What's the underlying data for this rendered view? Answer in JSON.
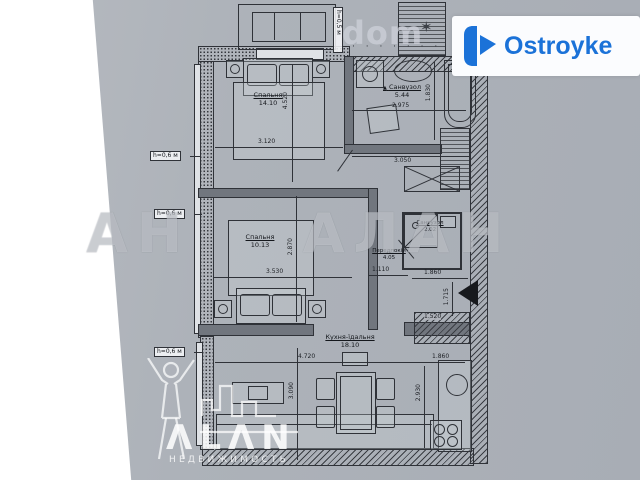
{
  "branding": {
    "ostroyke_label": "Ostroyke",
    "dom_label": "dom",
    "dom_dots": "· · · · · · ·",
    "star_icon": "✶",
    "watermark_big": "АН АЛАН",
    "alan_name": "ΛLΛN",
    "alan_subtitle": "НЕДВИЖИМОСТЬ"
  },
  "plan": {
    "drain_icon": "▲",
    "rooms": [
      {
        "name": "Спальня",
        "area": "14.10"
      },
      {
        "name": "Санвузол",
        "area": "5.44"
      },
      {
        "name": "Спальня",
        "area": "10.13"
      },
      {
        "name": "Санвузол",
        "area": "2.02"
      },
      {
        "name": "Передпокій",
        "area": "4.05"
      },
      {
        "name": "Кухня-їдальня",
        "area": "18.10"
      }
    ],
    "height_labels": [
      "h=0,6 м",
      "h=0,6 м",
      "h=0,6 м",
      "h=0,5 м"
    ],
    "dimensions": {
      "room1_w": "3.120",
      "room1_h": "4.520",
      "bath_w": "2.975",
      "bath_w2": "3.050",
      "bath_h": "1.830",
      "room2_w": "3.530",
      "room2_h": "2.870",
      "hall_w": "1.110",
      "entry_w": "1.860",
      "entry_h": "1.715",
      "shaft_w": "1.520",
      "kitchen_w": "4.720",
      "kitchen_w2": "1.860",
      "kitchen_h": "2.930",
      "kitchen_h2": "3.090"
    }
  }
}
